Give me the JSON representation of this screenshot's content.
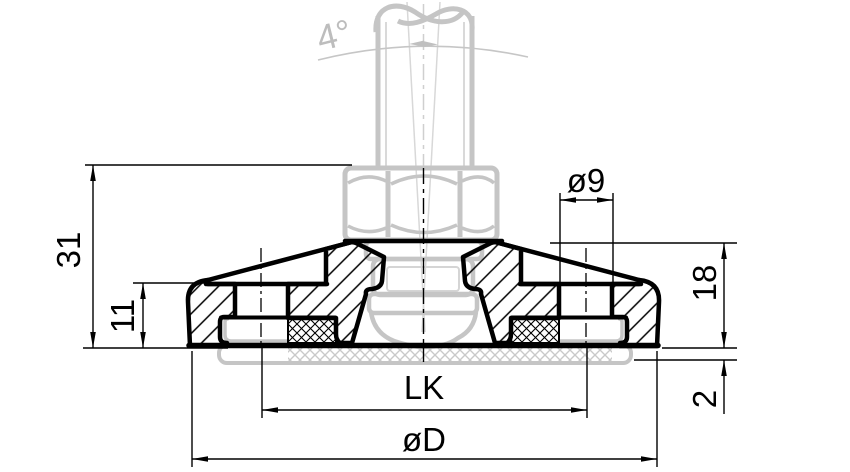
{
  "drawing": {
    "kind": "technical-section-drawing",
    "subject": "machine levelling foot, cross-section with swivel spindle",
    "background_color": "#ffffff",
    "line_color": "#000000",
    "phantom_color": "#c5c5c5",
    "dimensions": [
      {
        "id": "swivel-angle",
        "label": "4°"
      },
      {
        "id": "hole-diameter",
        "label": "ø9"
      },
      {
        "id": "overall-height",
        "label": "31"
      },
      {
        "id": "shoulder-height",
        "label": "11"
      },
      {
        "id": "base-height",
        "label": "18"
      },
      {
        "id": "pad-protrusion",
        "label": "2"
      },
      {
        "id": "bolt-circle-diameter",
        "label": "LK"
      },
      {
        "id": "base-diameter",
        "label": "øD"
      }
    ]
  }
}
